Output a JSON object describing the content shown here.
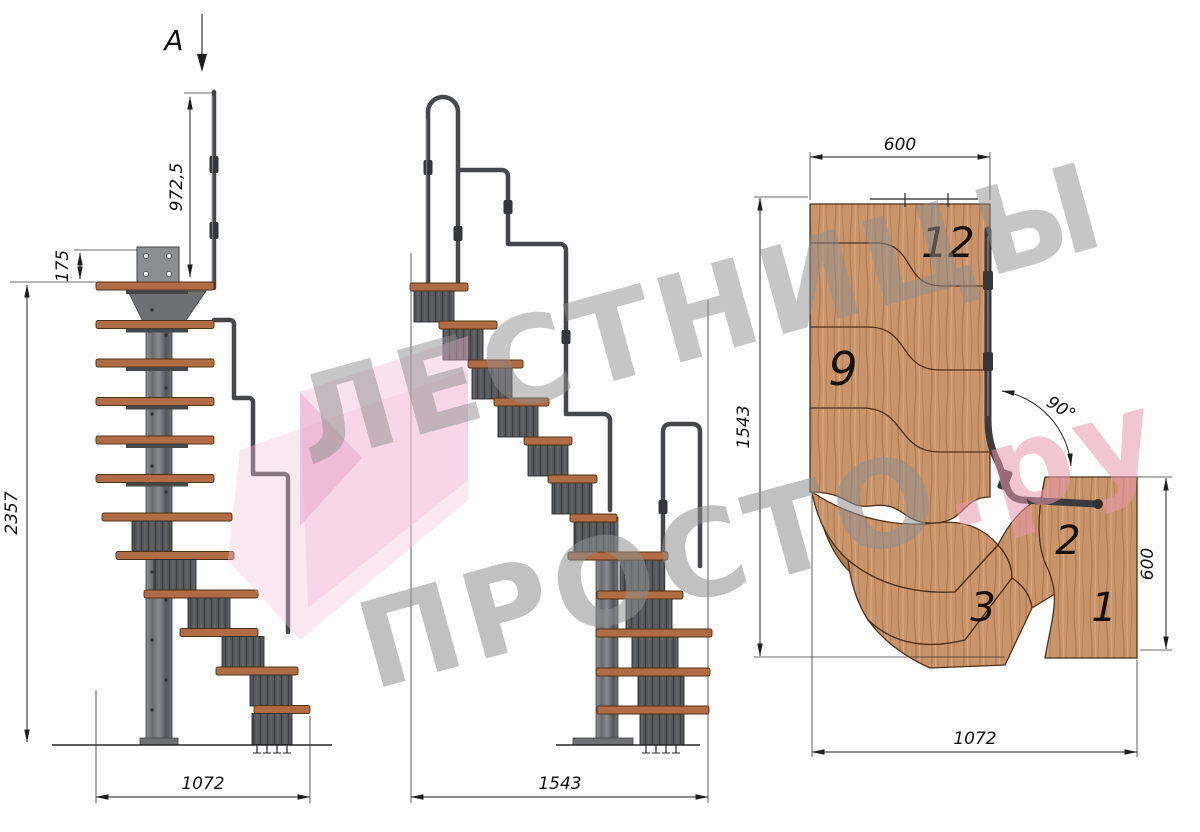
{
  "watermark": {
    "line1": "ЛЕСТНИЦЫ",
    "line2": "ПРОСТО",
    "line2_suffix": ".ру"
  },
  "side_view": {
    "section_label": "A",
    "dim_handrail_height": "972,5",
    "dim_bracket_height": "175",
    "dim_total_height": "2357",
    "dim_length": "1072"
  },
  "front_view": {
    "dim_width": "1543"
  },
  "plan_view": {
    "dim_top_width": "600",
    "dim_depth": "1543",
    "dim_right_width": "600",
    "dim_bottom_width": "1072",
    "turn_angle": "90°",
    "step_numbers": {
      "top": "12",
      "middle": "9",
      "winder3": "3",
      "winder2": "2",
      "first": "1"
    }
  },
  "colors": {
    "wood_plan": "#c9946a",
    "wood_tread": "#b06c44",
    "metal": "#55565a",
    "dimension_lines": "#1f1f20",
    "watermark_gray": "#8f8f8f",
    "watermark_pink": "#f0b9d6",
    "watermark_accent": "#e897ae"
  }
}
